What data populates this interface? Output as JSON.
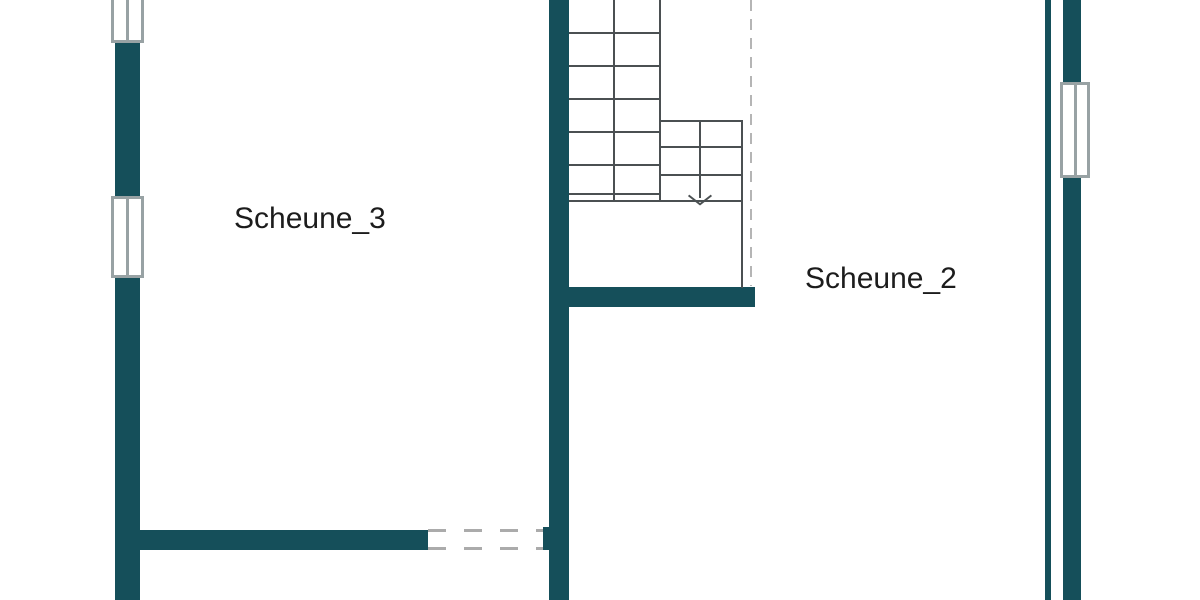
{
  "plan": {
    "title": "Scheune floor plan",
    "rooms": [
      {
        "label": "Scheune_3"
      },
      {
        "label": "Scheune_2"
      }
    ],
    "stair": {
      "direction": "down",
      "left_flight_tread_lines": 5,
      "right_flight_tread_lines": 2
    },
    "colors": {
      "wall": "#154f5a",
      "stair_line": "#4b5052",
      "window_frame": "#98a2a4",
      "dashed_boundary": "#b5b5b5",
      "dashed_window": "#ababab",
      "label_text": "#1c1c1c",
      "page_bg": "#ffffff"
    }
  }
}
